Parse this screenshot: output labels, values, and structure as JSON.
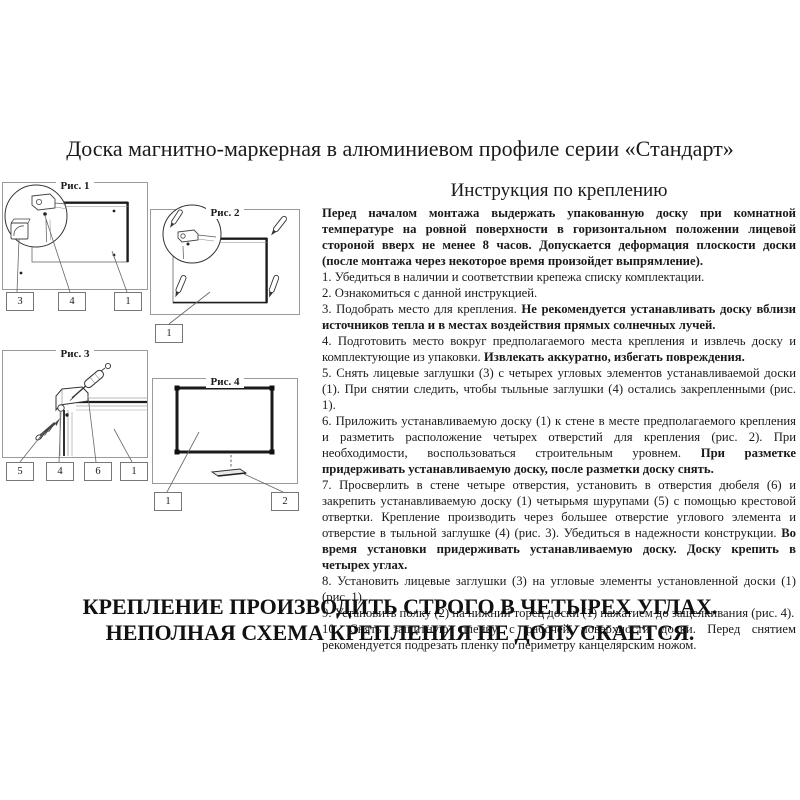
{
  "page": {
    "title": "Доска магнитно-маркерная в алюминиевом профиле серии «Стандарт»"
  },
  "figures": [
    {
      "caption": "Рис. 1",
      "labels": [
        "3",
        "4",
        "1"
      ]
    },
    {
      "caption": "Рис. 2",
      "labels": [
        "1"
      ]
    },
    {
      "caption": "Рис. 3",
      "labels": [
        "5",
        "4",
        "6",
        "1"
      ]
    },
    {
      "caption": "Рис. 4",
      "labels": [
        "1",
        "2"
      ]
    }
  ],
  "instructions": {
    "heading": "Инструкция по креплению",
    "intro": "Перед началом монтажа выдержать упакованную доску при комнатной температуре на ровной поверхности в горизонтальном положении лицевой стороной вверх не менее 8 часов. Допускается деформация плоскости доски (после монтажа через некоторое время произойдет выпрямление).",
    "items": [
      {
        "plain": "1. Убедиться в наличии и соответствии крепежа списку комплектации.",
        "bold": ""
      },
      {
        "plain": "2. Ознакомиться с данной инструкцией.",
        "bold": ""
      },
      {
        "plain": "3. Подобрать место для крепления. ",
        "bold": "Не рекомендуется устанавливать доску вблизи источников тепла и в местах воздействия прямых солнечных лучей."
      },
      {
        "plain": "4. Подготовить место вокруг предполагаемого места крепления и извлечь доску и комплектующие из упаковки. ",
        "bold": "Извлекать аккуратно, избегать повреждения."
      },
      {
        "plain": "5. Снять лицевые заглушки (3) с четырех угловых элементов устанавливаемой доски (1). При снятии следить, чтобы тыльные заглушки (4) остались закрепленными (рис. 1).",
        "bold": ""
      },
      {
        "plain": "6. Приложить устанавливаемую доску (1) к стене в месте предполагаемого крепления и разметить расположение четырех отверстий для крепления (рис. 2). При необходимости, воспользоваться строительным уровнем. ",
        "bold": "При разметке придерживать устанавливаемую доску, после разметки доску снять."
      },
      {
        "plain": "7. Просверлить в стене четыре отверстия, установить в отверстия дюбеля (6) и закрепить устанавливаемую доску (1) четырьмя шурупами (5) с помощью крестовой отвертки. Крепление производить через большее отверстие углового элемента и отверстие в тыльной заглушке (4) (рис. 3). Убедиться в надежности конструкции. ",
        "bold": "Во время установки придерживать устанавливаемую доску. Доску крепить в четырех углах."
      },
      {
        "plain": "8. Установить лицевые заглушки (3) на угловые элементы установленной доски (1) (рис. 1).",
        "bold": ""
      },
      {
        "plain": "9. Установить полку (2) на нижний торец доски (1) нажатием до защелкивания (рис. 4).",
        "bold": ""
      },
      {
        "plain": "10. Снять защитную пленку с рабочей поверхности доски. Перед снятием рекомендуется подрезать пленку по периметру канцелярским ножом.",
        "bold": ""
      }
    ]
  },
  "warning": {
    "line1": "КРЕПЛЕНИЕ ПРОИЗВОДИТЬ СТРОГО В ЧЕТЫРЕХ УГЛАХ.",
    "line2": "НЕПОЛНАЯ СХЕМА КРЕПЛЕНИЯ НЕ ДОПУСКАЕТСЯ."
  },
  "colors": {
    "ink": "#1a1a1a",
    "figure_frame": "#9a9a9a"
  }
}
